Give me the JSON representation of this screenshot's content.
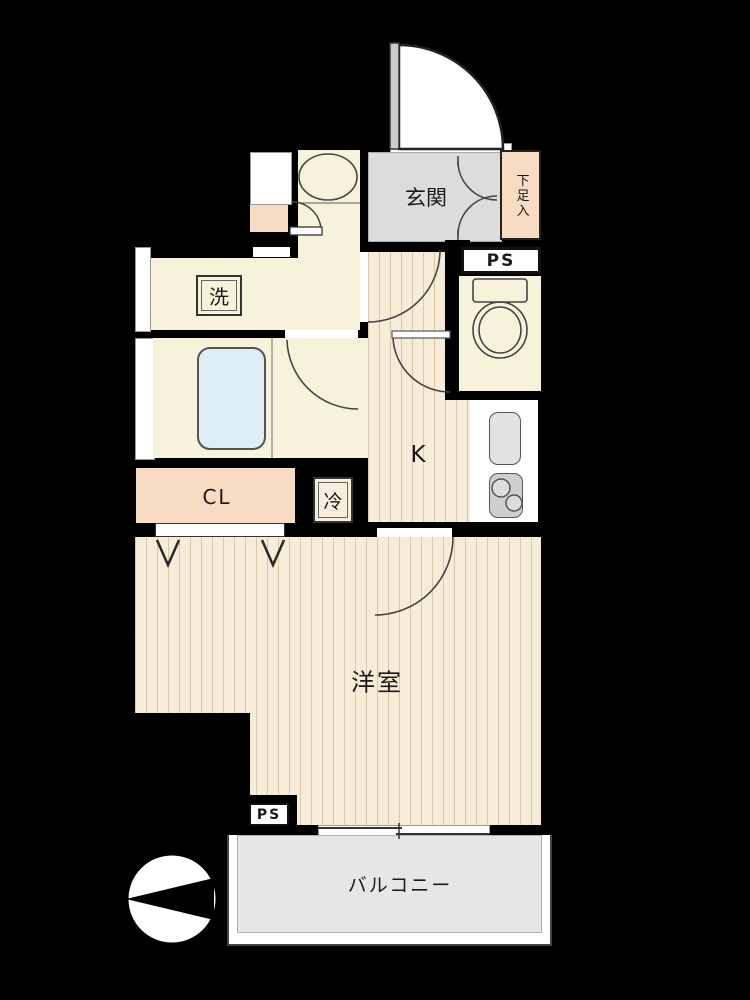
{
  "plan": {
    "type": "japanese-apartment-floorplan",
    "labels": {
      "genkan": "玄関",
      "shoe_cabinet": "下足入",
      "ps_top": "PS",
      "washer": "洗",
      "kitchen": "K",
      "fridge": "冷",
      "closet": "CL",
      "western_room": "洋室",
      "ps_bottom": "PS",
      "balcony": "バルコニー"
    },
    "icons": [
      "entrance-door-arc",
      "shoe-cabinet-doors",
      "toilet",
      "washbasin",
      "bathtub",
      "kitchen-sink",
      "stove-two-burners",
      "folding-closet-doors",
      "sliding-window",
      "compass-north-pointer"
    ],
    "colors": {
      "wall": "#000000",
      "room_cream": "#f6f3da",
      "floor_beige": "#f7ecd8",
      "floor_stripe": "#ab8c5f",
      "accent_peach": "#f8dcc2",
      "genkan_gray": "#dcdcdc",
      "balcony_gray": "#e6e6e6",
      "bathtub_blue": "#ddeef8",
      "fixture_gray": "#d9d9d9"
    }
  }
}
